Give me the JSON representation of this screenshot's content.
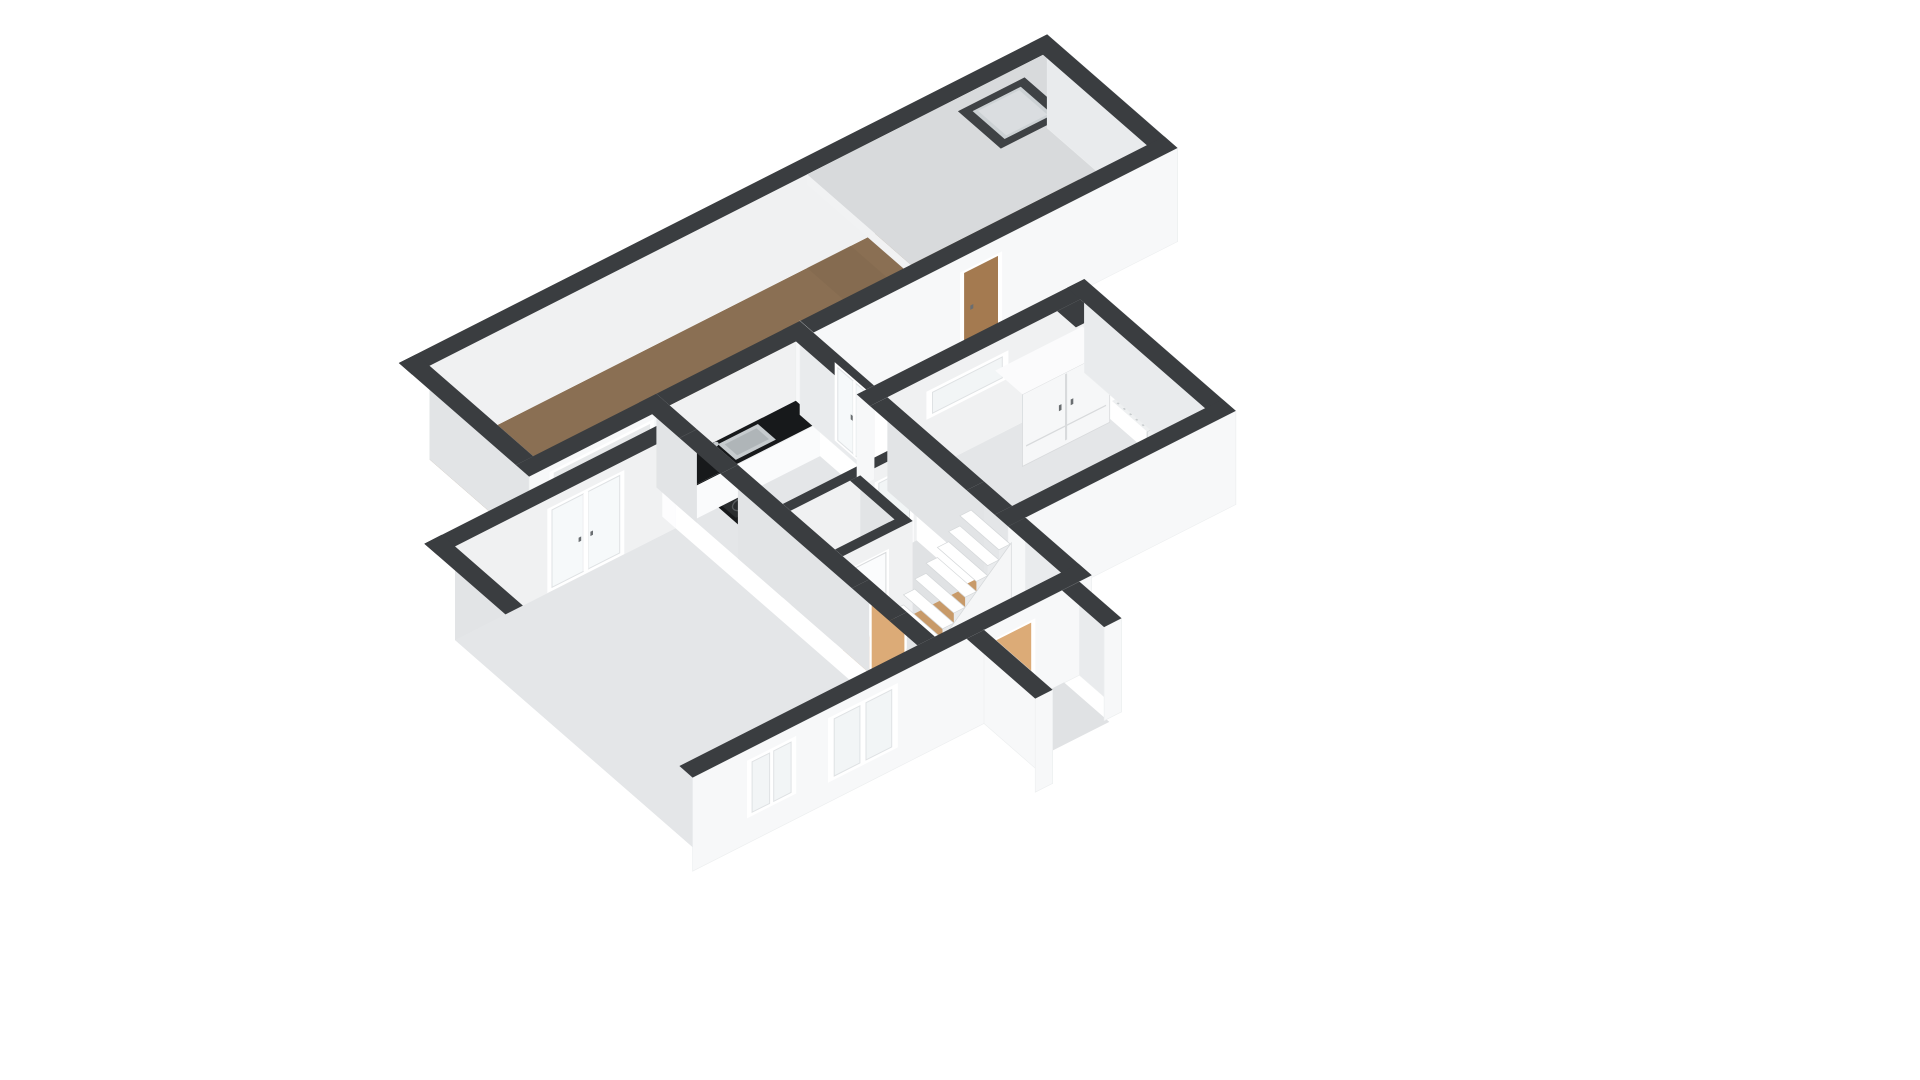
{
  "title": "3d-floorplan-ground-floor",
  "colors": {
    "background": "#ffffff",
    "wall_top": "#3a3d40",
    "ext_face_front": "#f7f8f9",
    "ext_face_side": "#e9ebed",
    "ext_face_bright": "#fdfdfe",
    "int_face_front": "#f0f1f2",
    "int_face_left": "#e2e4e6",
    "floor_gray": "#e4e6e8",
    "floor_gray2": "#e0e2e4",
    "floor_wood_dark": "#8a6f53",
    "floor_wood_light": "#c89a69",
    "roof_slab": "#d8dadc",
    "roof_fascia": "#f1f2f3",
    "skylight_frame": "#3f4245",
    "skylight_glass": "#ccd1d4",
    "skylight_inner": "#e6e8ea",
    "counter_top": "#17191b",
    "counter_front": "#fafbfc",
    "sink_outer": "#c6cbce",
    "sink_inner": "#afb5b8",
    "cooktop": "#2a2d2f",
    "cooktop_ring": "#55595c",
    "door_tan": "#dcab77",
    "door_brown": "#a47a50",
    "door_white": "#fbfcfd",
    "frame_white": "#ffffff",
    "glass": "#f2f5f6",
    "glass_bright": "#f6f9fa",
    "mullion": "#dfe2e4",
    "stair_tread": "#ffffff",
    "stair_side": "#e9ebed",
    "stair_stringer": "#f5f6f7",
    "step_edge": "#d5d8da",
    "garage_door": "#e7e9ea",
    "garage_slat": "#c3c7c9",
    "wardrobe_front": "#f6f7f8",
    "wardrobe_side": "#e8eaeb",
    "wardrobe_top": "#fbfbfc",
    "wardrobe_line": "#d8dadc",
    "radiator": "#eef0f1",
    "radiator_line": "#c8ccce",
    "handle": "#6a6e71",
    "shadow_wood": "#7a6249",
    "edge_light": "#eceeef"
  },
  "scene": {
    "rooms": [
      "garage-storage-wing",
      "living-room",
      "kitchen",
      "toilet",
      "hallway",
      "bedroom"
    ],
    "objects": [
      "garage-door",
      "skylight",
      "side-door",
      "french-doors",
      "kitchen-counter",
      "kitchen-sink",
      "cooktop",
      "kitchen-window",
      "glass-door",
      "staircase",
      "living-room-door",
      "front-door",
      "toilet-door",
      "bedroom-door",
      "slot-window",
      "wardrobe",
      "radiator",
      "porch-walls",
      "living-room-windows"
    ]
  }
}
